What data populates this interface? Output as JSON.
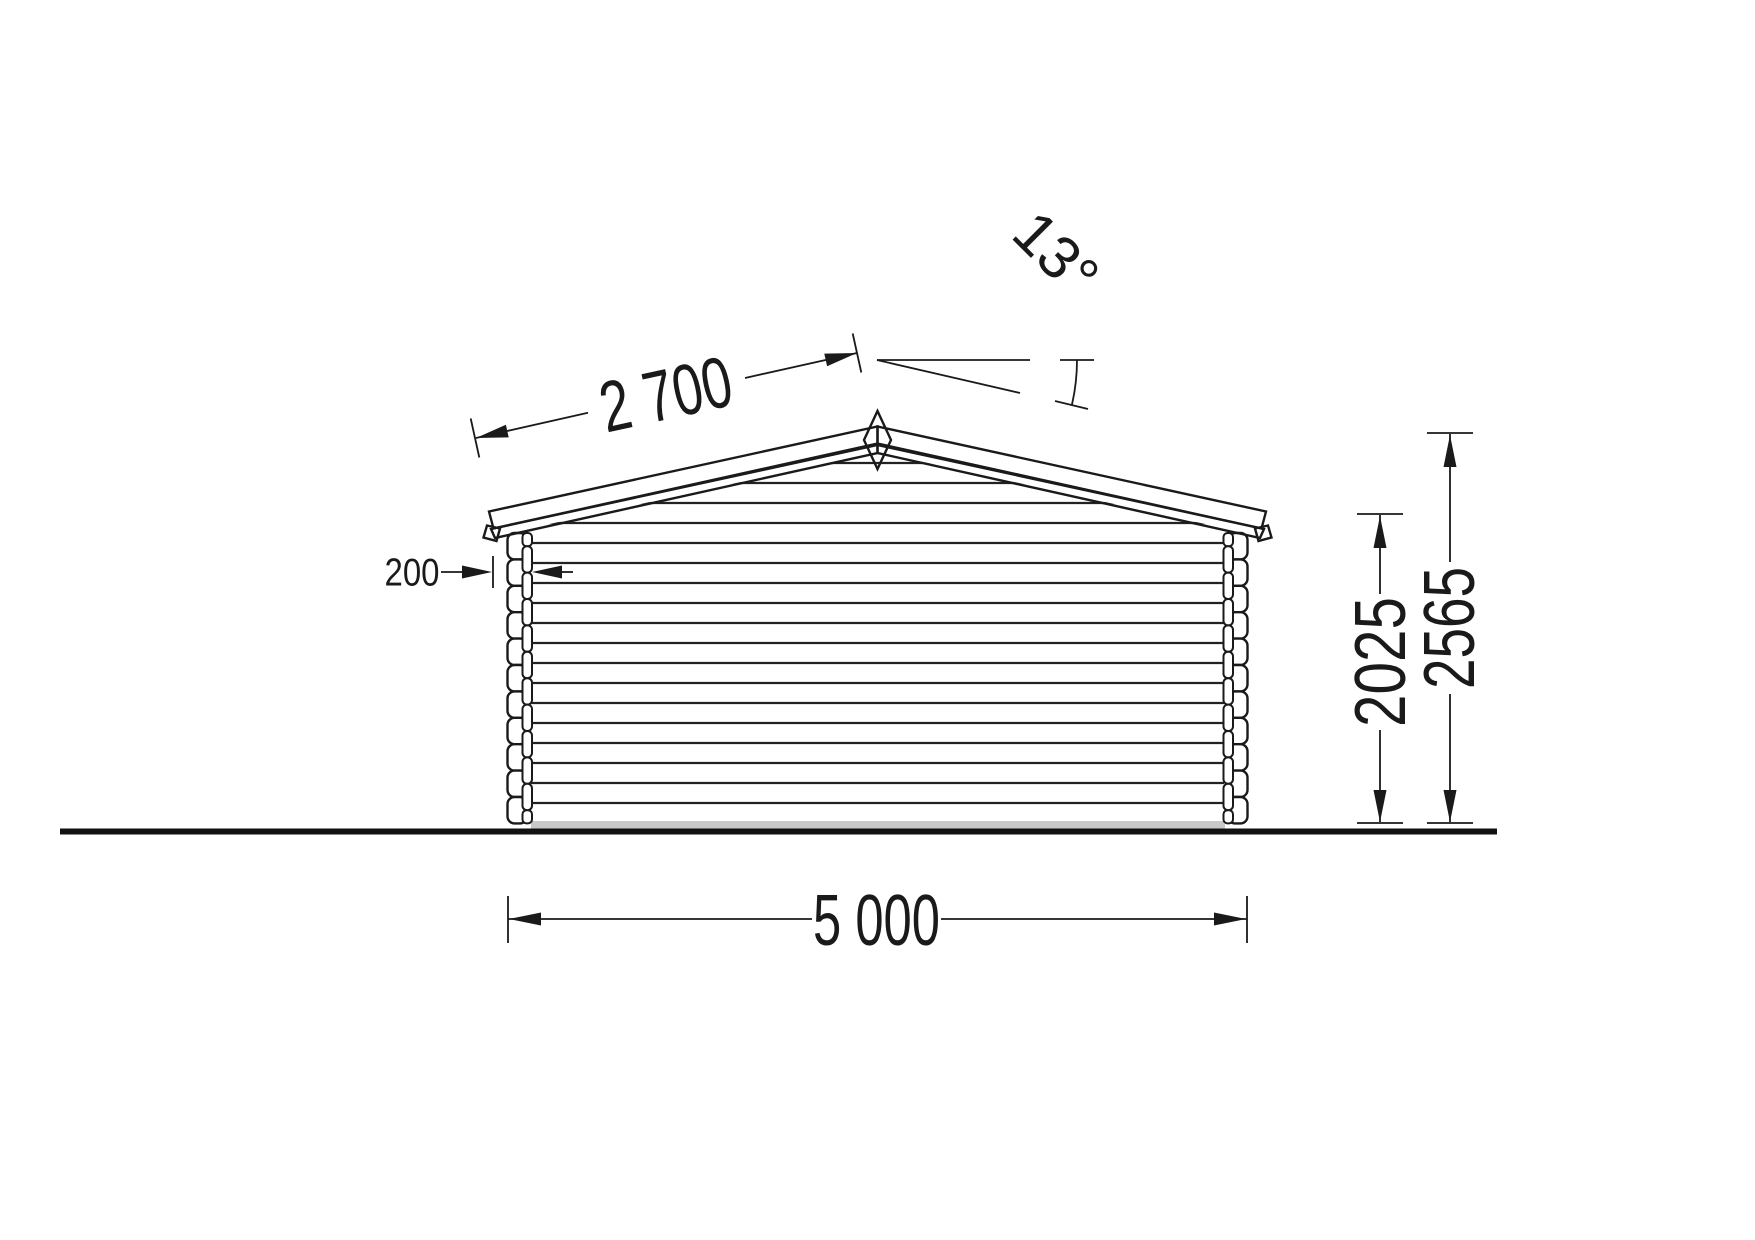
{
  "drawing": {
    "type": "technical-elevation",
    "subject": "log-cabin-front-elevation",
    "dimensions": {
      "roof_slope_length": "2 700",
      "roof_angle": "13°",
      "wall_log_thickness": "200",
      "wall_height": "2025",
      "ridge_height": "2565",
      "building_width": "5 000"
    },
    "colors": {
      "line": "#1a1a1a",
      "roof_fill": "#e0e0e0",
      "base_strip_fill": "#c9c9c9",
      "background": "#ffffff"
    }
  }
}
